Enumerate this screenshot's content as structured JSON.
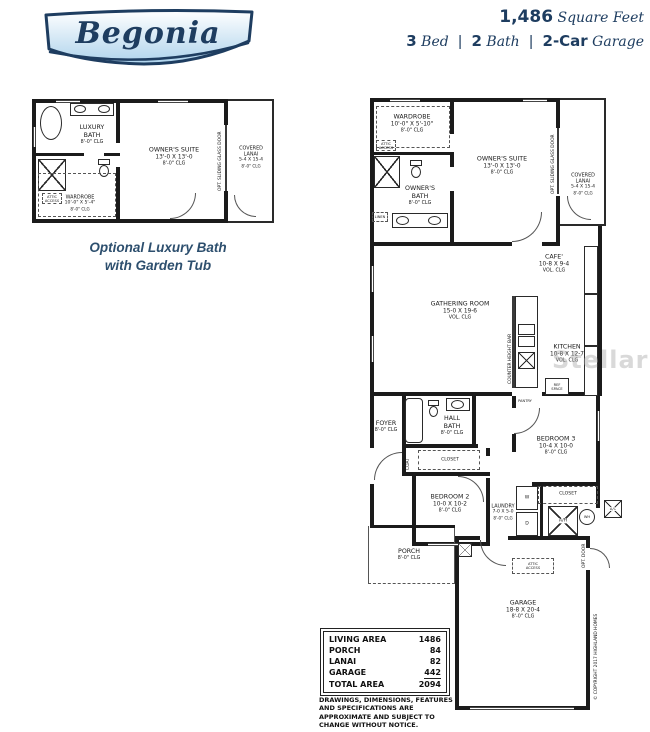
{
  "header": {
    "plan_name": "Begonia",
    "stats": {
      "sqft_value": "1,486",
      "sqft_label": "Square Feet",
      "bed_value": "3",
      "bed_label": "Bed",
      "bath_value": "2",
      "bath_label": "Bath",
      "garage_value": "2-Car",
      "garage_label": "Garage",
      "sep": "|"
    }
  },
  "inset": {
    "caption1": "Optional Luxury Bath",
    "caption2": "with Garden Tub",
    "rooms": {
      "luxury_bath": {
        "name": "LUXURY",
        "name2": "BATH",
        "clg": "8'-0\" CLG"
      },
      "owners_suite": {
        "name": "OWNER'S SUITE",
        "dims": "13'-0 X 13'-0",
        "clg": "8'-0\" CLG"
      },
      "wardrobe": {
        "name": "WARDROBE",
        "dims": "10'-0\" X 5'-4\"",
        "clg": "8'-0\" CLG"
      },
      "covered_lanai": {
        "name": "COVERED",
        "name2": "LANAI",
        "dims": "5-4 X 15-4",
        "clg": "8'-0\" CLG"
      }
    },
    "labels": {
      "opt_sliding": "OPT. SLIDING GLASS DOOR",
      "attic_line1": "ATTIC",
      "attic_line2": "ACCESS"
    }
  },
  "main": {
    "rooms": {
      "wardrobe": {
        "name": "WARDROBE",
        "dims": "10'-0\" X 5'-10\"",
        "clg": "8'-0\" CLG"
      },
      "owners_suite": {
        "name": "OWNER'S SUITE",
        "dims": "13'-0 X 13'-0",
        "clg": "8'-0\" CLG"
      },
      "covered_lanai": {
        "name": "COVERED",
        "name2": "LANAI",
        "dims": "5-4 X 15-4",
        "clg": "8'-0\" CLG"
      },
      "owners_bath": {
        "name": "OWNER'S",
        "name2": "BATH",
        "clg": "8'-0\" CLG"
      },
      "cafe": {
        "name": "CAFE'",
        "dims": "10-8 X 9-4",
        "clg": "VOL. CLG"
      },
      "gathering": {
        "name": "GATHERING ROOM",
        "dims": "15-0 X 19-6",
        "clg": "VOL. CLG"
      },
      "kitchen": {
        "name": "KITCHEN",
        "dims": "10-8 X 12-7",
        "clg": "VOL. CLG"
      },
      "foyer": {
        "name": "FOYER",
        "clg": "8'-0\" CLG"
      },
      "hall_bath": {
        "name": "HALL",
        "name2": "BATH",
        "clg": "8'-0\" CLG"
      },
      "bedroom2": {
        "name": "BEDROOM 2",
        "dims": "10-0 X 10-2",
        "clg": "8'-0\" CLG"
      },
      "bedroom3": {
        "name": "BEDROOM 3",
        "dims": "10-4 X 10-0",
        "clg": "8'-0\" CLG"
      },
      "laundry": {
        "name": "LAUNDRY",
        "dims": "7-0 X 5-0",
        "clg": "8'-0\" CLG"
      },
      "porch": {
        "name": "PORCH",
        "clg": "8'-0\" CLG"
      },
      "garage": {
        "name": "GARAGE",
        "dims": "18-8 X 20-4",
        "clg": "8'-0\" CLG"
      }
    },
    "labels": {
      "opt_sliding": "OPT. SLIDING GLASS DOOR",
      "counter_bar": "COUNTER HEIGHT BAR",
      "linen": "LINEN",
      "closet": "CLOSET",
      "coat": "COAT",
      "pantry": "PANTRY",
      "ref_line1": "REF",
      "ref_line2": "SPACE",
      "attic_line1": "ATTIC",
      "attic_line2": "ACCESS",
      "washer": "W",
      "dryer": "D",
      "air_handler": "A/H",
      "water_heater": "WH",
      "ac": "A/C",
      "opt_door": "OPT. DOOR",
      "copyright": "© COPYRIGHT 2017 HIGHLAND HOMES"
    }
  },
  "area_table": {
    "rows": [
      {
        "label": "LIVING AREA",
        "value": "1486"
      },
      {
        "label": "PORCH",
        "value": "84"
      },
      {
        "label": "LANAI",
        "value": "82"
      },
      {
        "label": "GARAGE",
        "value": "442"
      },
      {
        "label": "TOTAL AREA",
        "value": "2094"
      }
    ]
  },
  "disclaimer": "DRAWINGS, DIMENSIONS, FEATURES AND SPECIFICATIONS ARE APPROXIMATE AND SUBJECT TO CHANGE WITHOUT NOTICE.",
  "watermark": "StellarMLS",
  "colors": {
    "navy": "#1e3d60",
    "caption_blue": "#2d4f6e",
    "banner_fill": "#aed3ec",
    "wall": "#1b1b1b",
    "watermark_gray": "#aaaaaa"
  }
}
